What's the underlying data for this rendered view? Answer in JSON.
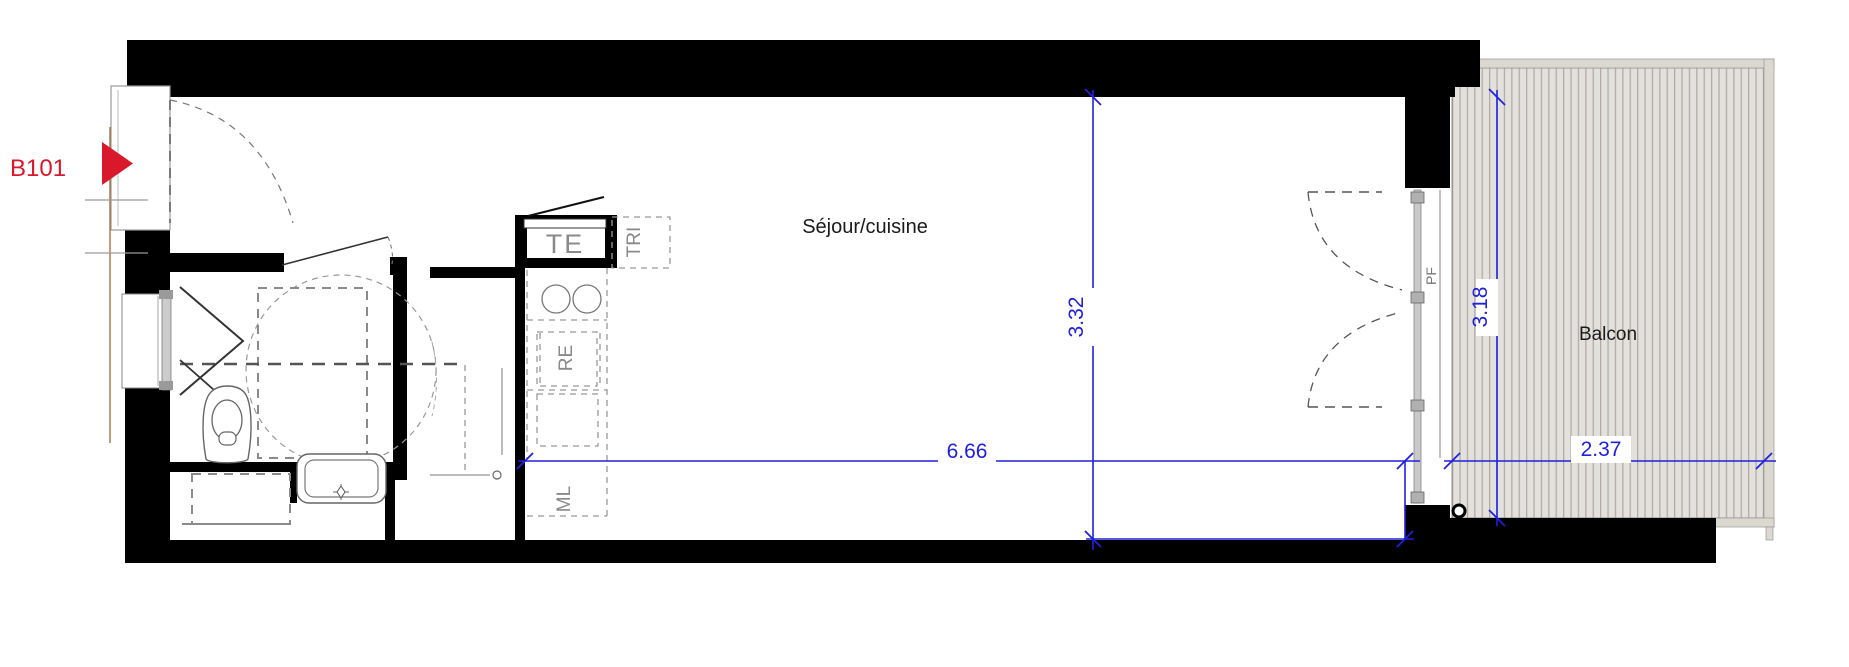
{
  "plan": {
    "unit": {
      "label": "B101"
    },
    "rooms": {
      "living": "Séjour/cuisine",
      "balcony": "Balcon"
    },
    "tags": {
      "te": "TE",
      "tri": "TRI",
      "re": "RE",
      "ml": "ML",
      "pf": "PF"
    },
    "dims": {
      "living_width_m": "6.66",
      "living_depth_m": "3.32",
      "balcony_width_m": "2.37",
      "balcony_depth_m": "3.18"
    },
    "colors": {
      "dimension_blue": "#2020df",
      "unit_red": "#d9182b",
      "wall_black": "#000000",
      "balcony_fill": "#e2e1de",
      "balcony_stripe": "#b5ac9f",
      "grey_label": "#8a8a8a"
    }
  }
}
